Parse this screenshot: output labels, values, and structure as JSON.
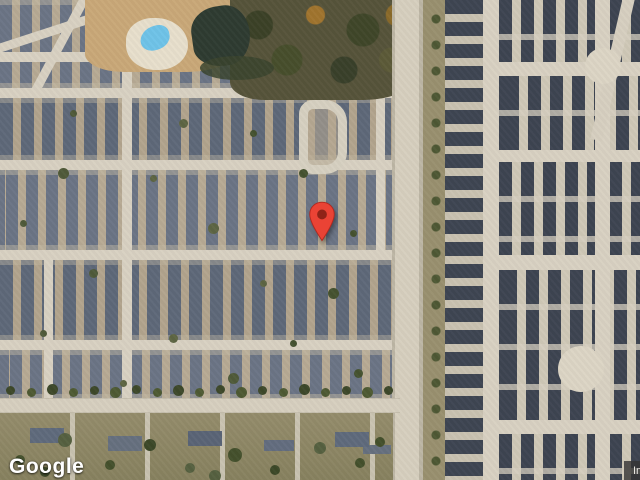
{
  "map": {
    "view_type": "satellite",
    "marker": {
      "name": "location-pin",
      "fill_color": "#EA4335",
      "dot_color": "#8E2318",
      "position": {
        "x": 322,
        "y": 243
      }
    }
  },
  "branding": {
    "logo_text": "Google"
  },
  "attribution": {
    "text": "Imagery ©2025 Airbus, Maxar Technologies, Vexcel Imaging US, Inc."
  },
  "colors": {
    "roof_left_neighborhood": "#6B7485",
    "roof_right_neighborhood": "#3D4451",
    "street": "#D8D1C2",
    "ground": "#B7AA94",
    "pond_water": "#2E3B31",
    "pool_water": "#6FC3E8",
    "attribution_background": "rgba(51,51,51,0.8)"
  }
}
